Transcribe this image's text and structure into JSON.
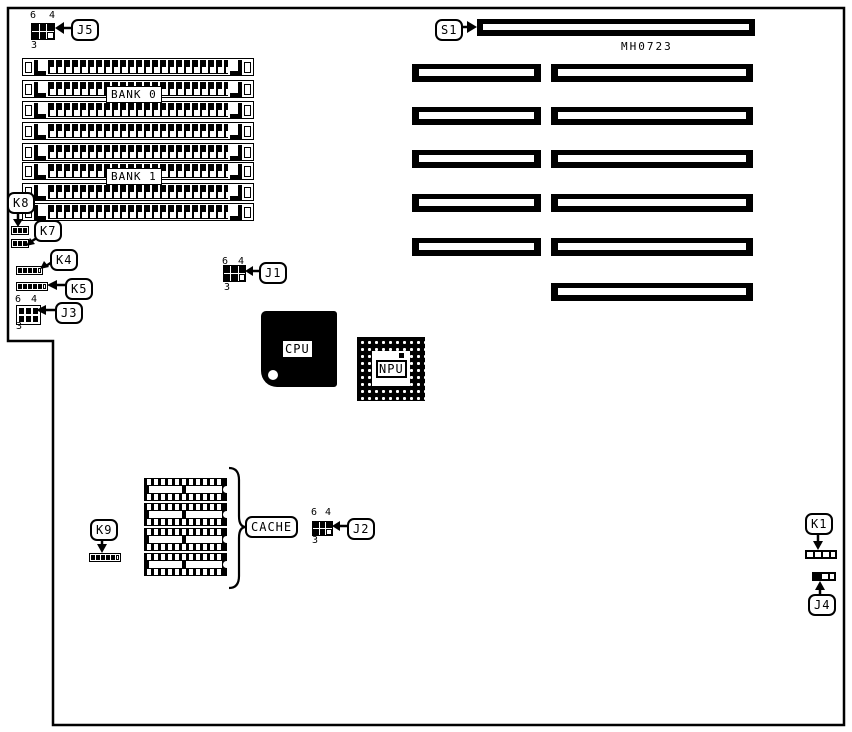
{
  "board": {
    "part_number": "MH0723"
  },
  "memory": {
    "bank0_label": "BANK 0",
    "bank1_label": "BANK 1"
  },
  "chips": {
    "cpu": "CPU",
    "npu": "NPU",
    "cache": "CACHE"
  },
  "jumper_pins": {
    "six": "6",
    "four": "4",
    "three": "3"
  },
  "callouts": {
    "s1": "S1",
    "j1": "J1",
    "j2": "J2",
    "j3": "J3",
    "j4": "J4",
    "j5": "J5",
    "k1": "K1",
    "k4": "K4",
    "k5": "K5",
    "k7": "K7",
    "k8": "K8",
    "k9": "K9"
  },
  "colors": {
    "ink": "#000000",
    "paper": "#ffffff"
  }
}
